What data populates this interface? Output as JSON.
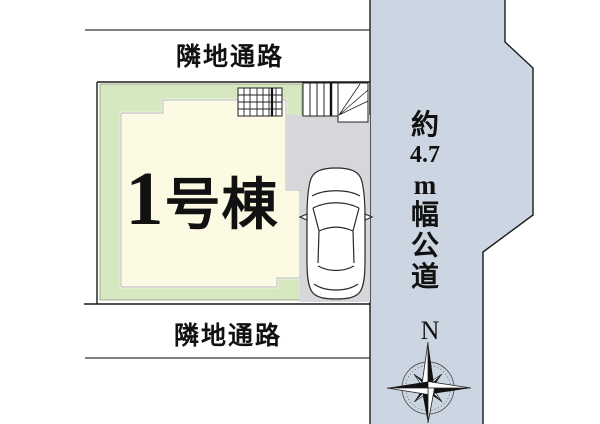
{
  "labels": {
    "top_passage": "隣地通路",
    "bottom_passage": "隣地通路",
    "building_number": "1",
    "building_suffix": "号棟",
    "building_full": "1号棟",
    "road": "約4.7m幅公道",
    "road_segments": [
      "約",
      "4.7",
      "m",
      "幅",
      "公",
      "道"
    ],
    "compass_north": "N"
  },
  "colors": {
    "road_fill": "#ccd6e2",
    "green_area": "#d6e8c0",
    "building_fill": "#fcfae2",
    "parking_fill": "#d5d7da",
    "line": "#1a1a1a"
  },
  "icons": {
    "compass": "compass-rose-icon",
    "car": "car-top-view-icon"
  }
}
